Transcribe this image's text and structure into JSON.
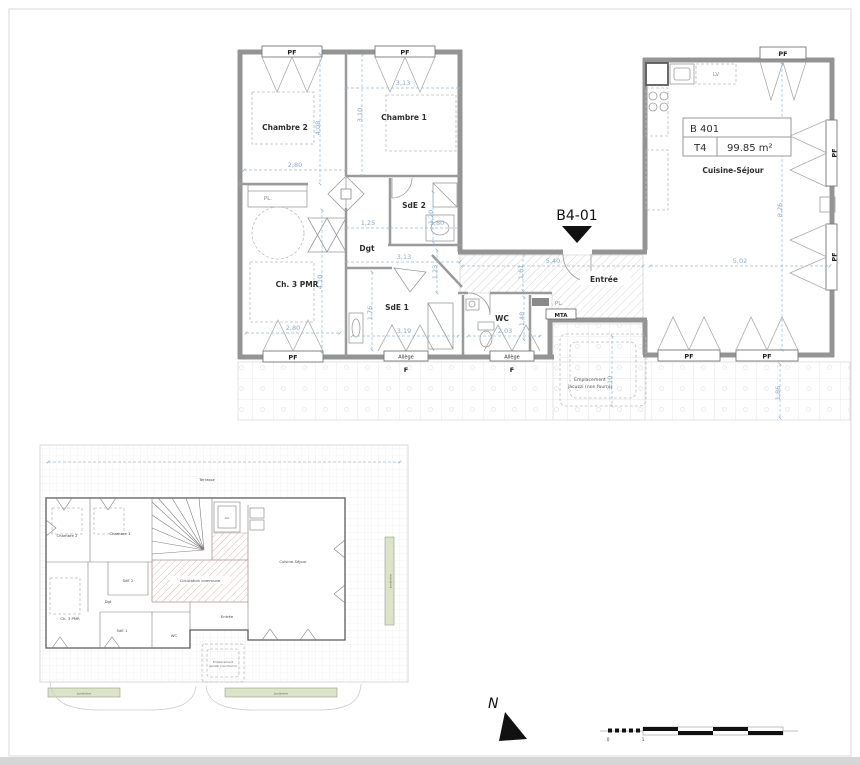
{
  "top_plan": {
    "marker": "B4-01",
    "unit": {
      "code": "B 401",
      "type": "T4",
      "area": "99.85 m²"
    },
    "rooms": {
      "chambre2": "Chambre 2",
      "chambre1": "Chambre 1",
      "sde2": "SdE 2",
      "dgt": "Dgt",
      "ch3pmr": "Ch. 3 PMR",
      "sde1": "SdE 1",
      "wc": "WC",
      "entree": "Entrée",
      "cuisine": "Cuisine-Séjour"
    },
    "fixtures": {
      "lv": "LV",
      "pl_chambre": "PL.",
      "pl_entree": "PL.",
      "mta": "MTA"
    },
    "windows": {
      "pf": "PF",
      "f": "F",
      "allege": "Allège"
    },
    "jacuzzi": {
      "line1": "Emplacement",
      "line2": "jacuzzi (non fourni)"
    },
    "dims": {
      "w_ch1": "3,13",
      "h_ch1": "3,10",
      "w_ch2": "2,80",
      "h_ch2": "4,08",
      "w_dgt": "1,25",
      "w_sde2": "1,80",
      "h_sde2": "1,20",
      "w_dgt2": "3,13",
      "h_dgt": "1,23",
      "h_pmr": "4,10",
      "w_pmr": "2,80",
      "h_sde1": "1,76",
      "w_sde1": "3,19",
      "w_wc": "2,03",
      "h_wc": "1,48",
      "h_entree": "1,61",
      "w_entree": "5,40",
      "w_cuisine": "5,02",
      "h_cuisine": "8,26",
      "h_balcon": "1,86",
      "h_jacuzzi": "3,10"
    }
  },
  "overview_plan": {
    "terrasse": "Terrasse",
    "rooms": {
      "chambre2": "Chambre 2",
      "chambre1": "Chambre 1",
      "sde2": "SdE 2",
      "dgt": "Dgt",
      "ch3pmr": "Ch. 3 PMR",
      "sde1": "SdE 1",
      "wc": "WC",
      "entree": "Entrée",
      "cuisine": "Cuisine-Séjour",
      "asc": "Asc"
    },
    "circulation": "Circulation commune",
    "jacuzzi": {
      "line1": "Emplacement",
      "line2": "jacuzzi (non fourni)"
    },
    "jardiniere": "Jardinière"
  },
  "compass": {
    "north": "N"
  },
  "scale_bar": {
    "zero": "0",
    "one": "1"
  },
  "colors": {
    "dimension_blue": "#85acd0",
    "wall_gray": "#949494",
    "hatch_red": "#cf9d9d",
    "jardiniere_green": "#dde3c6"
  }
}
